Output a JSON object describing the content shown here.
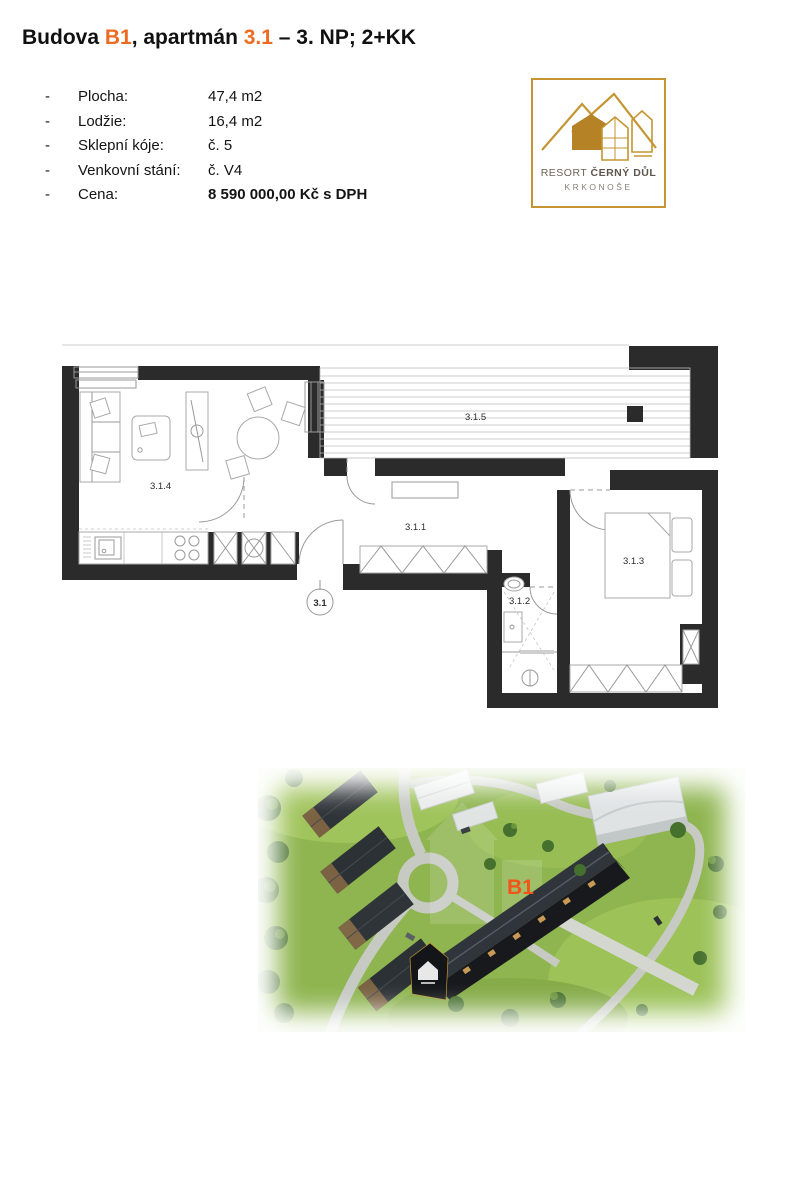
{
  "title": {
    "part1": "Budova ",
    "highlight1": "B1",
    "part2": ", apartmán ",
    "highlight2": "3.1",
    "part3": " – 3. NP; 2+KK",
    "highlight_color": "#ED6B21"
  },
  "details": {
    "bullet": "-",
    "rows": [
      {
        "label": "Plocha:",
        "value": "47,4 m2"
      },
      {
        "label": "Lodžie:",
        "value": "16,4 m2"
      },
      {
        "label": "Sklepní kóje:",
        "value": "č. 5"
      },
      {
        "label": "Venkovní stání:",
        "value": "č. V4"
      },
      {
        "label": "Cena:",
        "value": "8 590 000,00 Kč s DPH"
      }
    ]
  },
  "logo": {
    "name_regular": "RESORT ",
    "name_bold": "ČERNÝ DŮL",
    "subtitle": "KRKONOŠE",
    "gold": "#C49531"
  },
  "floorplan": {
    "wall_color": "#2b2b2b",
    "labels": {
      "living": "3.1.4",
      "loggia": "3.1.5",
      "hall": "3.1.1",
      "bathroom": "3.1.2",
      "bedroom": "3.1.3",
      "entry": "3.1"
    }
  },
  "render": {
    "building_label": "B1",
    "label_color": "#F2541A"
  }
}
